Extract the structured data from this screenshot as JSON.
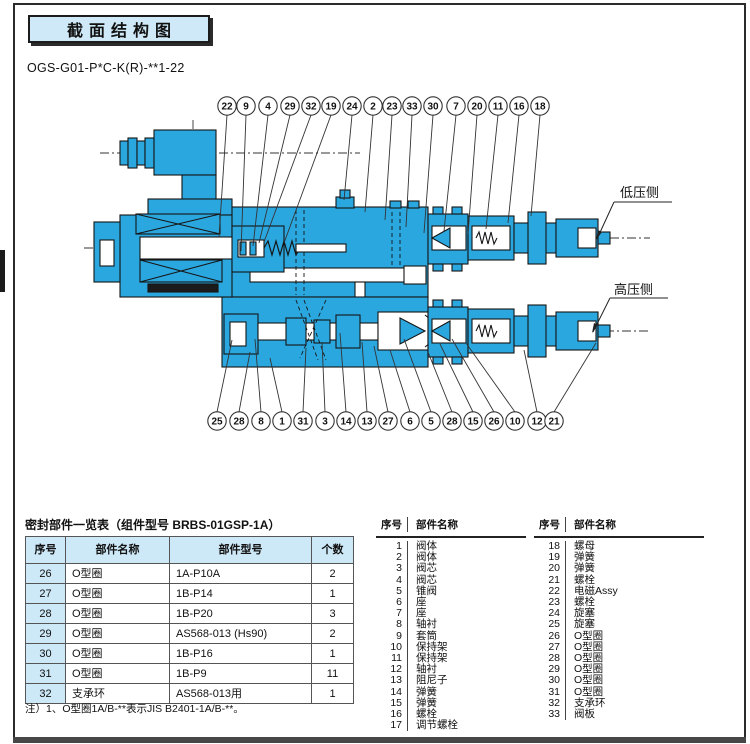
{
  "page": {
    "title": "截面结构图",
    "model_code": "OGS-G01-P*C-K(R)-**1-22"
  },
  "diagram": {
    "low_pressure_label": "低压侧",
    "high_pressure_label": "高压侧",
    "top_callouts": [
      "22",
      "9",
      "4",
      "29",
      "32",
      "19",
      "24",
      "2",
      "23",
      "33",
      "30",
      "7",
      "20",
      "11",
      "16",
      "18"
    ],
    "bottom_callouts": [
      "25",
      "28",
      "8",
      "1",
      "31",
      "3",
      "14",
      "13",
      "27",
      "6",
      "5",
      "28",
      "15",
      "26",
      "10",
      "12",
      "21"
    ]
  },
  "seal_table": {
    "title": "密封部件一览表（组件型号 BRBS-01GSP-1A）",
    "headers": [
      "序号",
      "部件名称",
      "部件型号",
      "个数"
    ],
    "rows": [
      [
        "26",
        "O型圈",
        "1A-P10A",
        "2"
      ],
      [
        "27",
        "O型圈",
        "1B-P14",
        "1"
      ],
      [
        "28",
        "O型圈",
        "1B-P20",
        "3"
      ],
      [
        "29",
        "O型圈",
        "AS568-013 (Hs90)",
        "2"
      ],
      [
        "30",
        "O型圈",
        "1B-P16",
        "1"
      ],
      [
        "31",
        "O型圈",
        "1B-P9",
        "11"
      ],
      [
        "32",
        "支承环",
        "AS568-013用",
        "1"
      ]
    ],
    "note": "注）1、O型圈1A/B-**表示JIS B2401-1A/B-**。"
  },
  "parts_list_left": {
    "headers": [
      "序号",
      "部件名称"
    ],
    "rows": [
      [
        "1",
        "阀体"
      ],
      [
        "2",
        "阀体"
      ],
      [
        "3",
        "阀芯"
      ],
      [
        "4",
        "阀芯"
      ],
      [
        "5",
        "锥阀"
      ],
      [
        "6",
        "座"
      ],
      [
        "7",
        "座"
      ],
      [
        "8",
        "轴衬"
      ],
      [
        "9",
        "套筒"
      ],
      [
        "10",
        "保持架"
      ],
      [
        "11",
        "保持架"
      ],
      [
        "12",
        "轴衬"
      ],
      [
        "13",
        "阻尼子"
      ],
      [
        "14",
        "弹簧"
      ],
      [
        "15",
        "弹簧"
      ],
      [
        "16",
        "螺栓"
      ],
      [
        "17",
        "调节螺栓"
      ]
    ]
  },
  "parts_list_right": {
    "headers": [
      "序号",
      "部件名称"
    ],
    "rows": [
      [
        "18",
        "螺母"
      ],
      [
        "19",
        "弹簧"
      ],
      [
        "20",
        "弹簧"
      ],
      [
        "21",
        "螺栓"
      ],
      [
        "22",
        "电磁Assy"
      ],
      [
        "23",
        "螺栓"
      ],
      [
        "24",
        "旋塞"
      ],
      [
        "25",
        "旋塞"
      ],
      [
        "26",
        "O型圈"
      ],
      [
        "27",
        "O型圈"
      ],
      [
        "28",
        "O型圈"
      ],
      [
        "29",
        "O型圈"
      ],
      [
        "30",
        "O型圈"
      ],
      [
        "31",
        "O型圈"
      ],
      [
        "32",
        "支承环"
      ],
      [
        "33",
        "阀板"
      ]
    ]
  },
  "colors": {
    "diagram_blue": "#2BA7E0",
    "header_bg": "#CFE9F8",
    "table_header_bg": "#CDE8F7"
  }
}
